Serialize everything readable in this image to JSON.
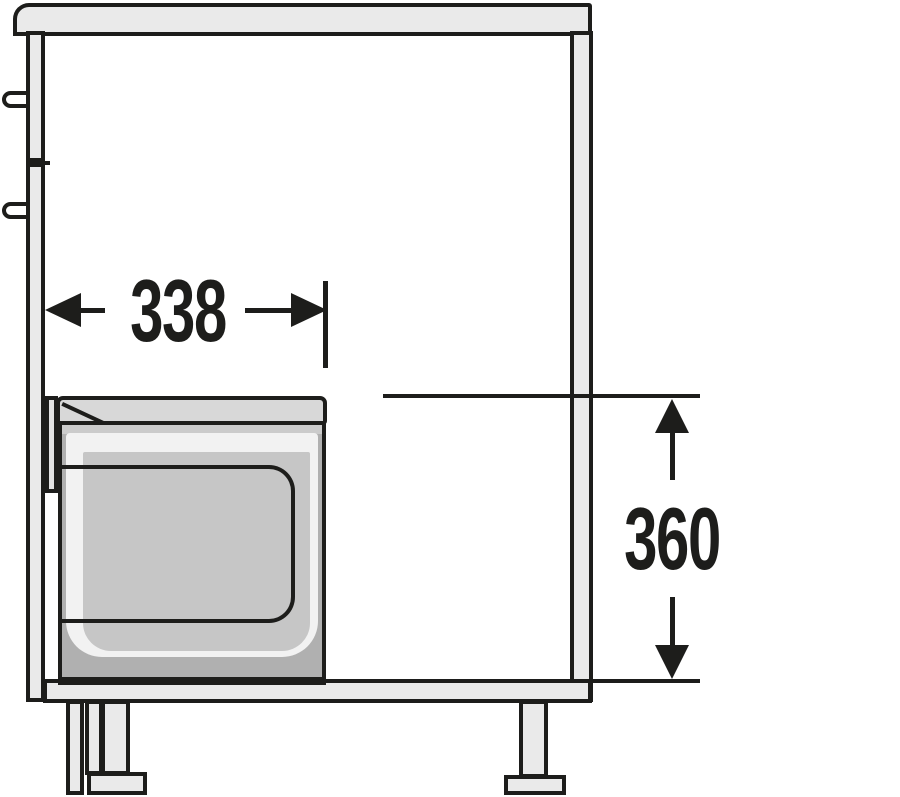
{
  "drawing": {
    "title": "cabinet-waste-bin-side-view",
    "dimensions": {
      "width": {
        "value": "338",
        "orientation": "horizontal"
      },
      "height": {
        "value": "360",
        "orientation": "vertical"
      }
    },
    "colors": {
      "ink": "#1d1d1b",
      "light": "#eaeaea",
      "lid": "#d8d8d8",
      "bin": "#b0b0b0",
      "bin-inner": "#c6c6c6",
      "rim": "#f2f2f2",
      "strip": "#cbcbcb",
      "bracket": "#e2e2e2",
      "bg": "#ffffff"
    }
  }
}
